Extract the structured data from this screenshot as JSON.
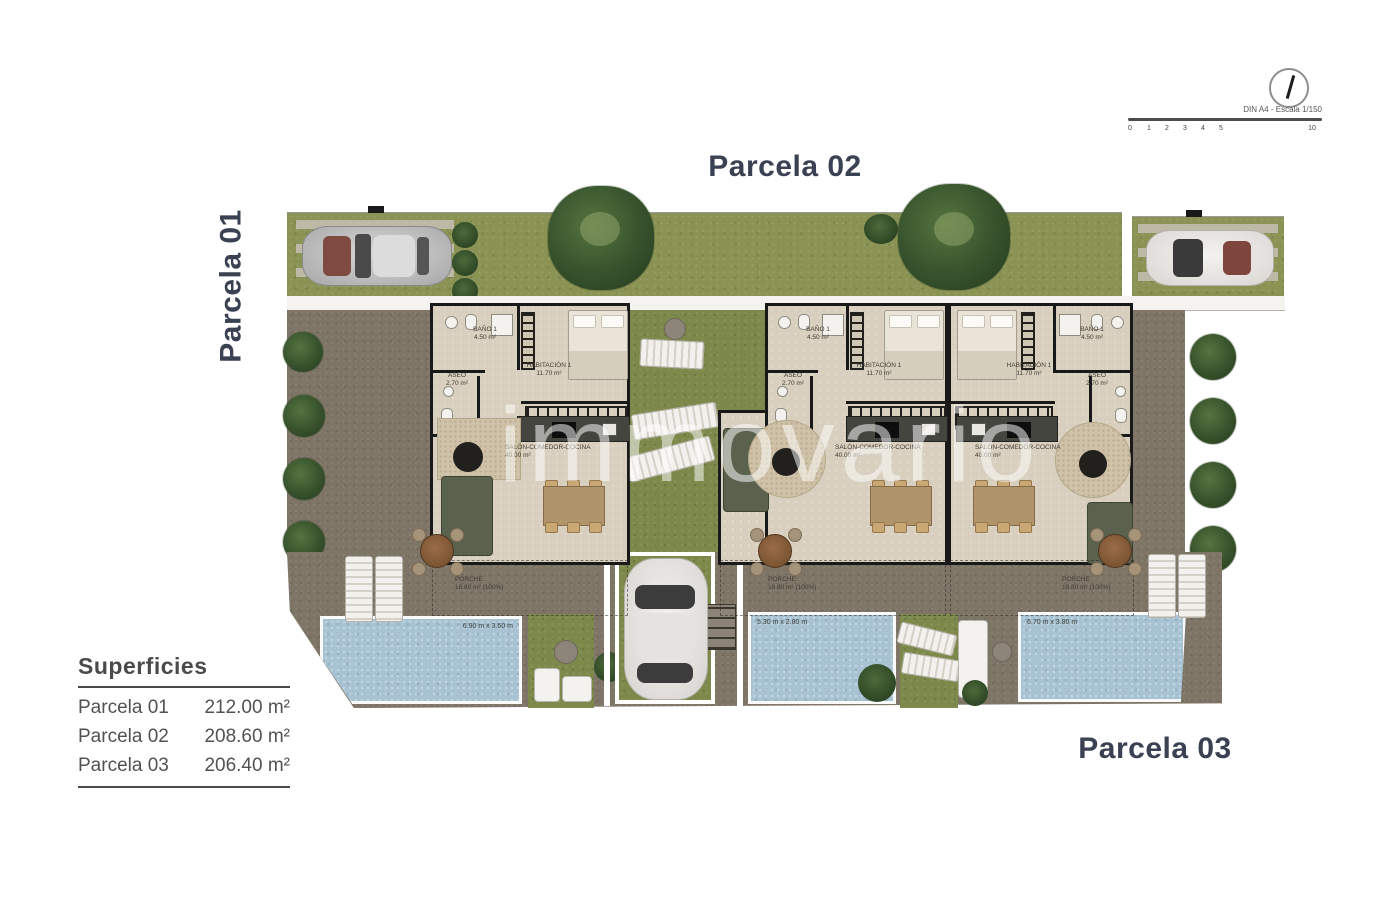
{
  "header": {
    "north_scale_note": "DIN A4 - Escala 1/150",
    "scale_ticks": [
      "0",
      "1",
      "2",
      "3",
      "4",
      "5",
      "10"
    ]
  },
  "titles": {
    "p1": "Parcela 01",
    "p2": "Parcela 02",
    "p3": "Parcela 03"
  },
  "legend": {
    "title": "Superficies",
    "rows": [
      {
        "label": "Parcela 01",
        "value": "212.00 m²"
      },
      {
        "label": "Parcela 02",
        "value": "208.60 m²"
      },
      {
        "label": "Parcela 03",
        "value": "206.40 m²"
      }
    ]
  },
  "watermark": "immovario",
  "rooms": {
    "bano": {
      "name": "BAÑO 1",
      "area": "4.50 m²"
    },
    "aseo": {
      "name": "ASEO",
      "area": "2.70 m²"
    },
    "habitacion": {
      "name": "HABITACIÓN 1",
      "area": "11.70 m²"
    },
    "salon": {
      "name": "SALÓN-COMEDOR-COCINA",
      "area": "40.00 m²"
    },
    "porche": {
      "name": "PORCHE",
      "area": "18.80 m² (100%)"
    }
  },
  "pools": [
    {
      "dim": "6.90 m x 3.60 m"
    },
    {
      "dim": "5.30 m x 2.80 m"
    },
    {
      "dim": "6.70 m x 3.80 m"
    }
  ]
}
